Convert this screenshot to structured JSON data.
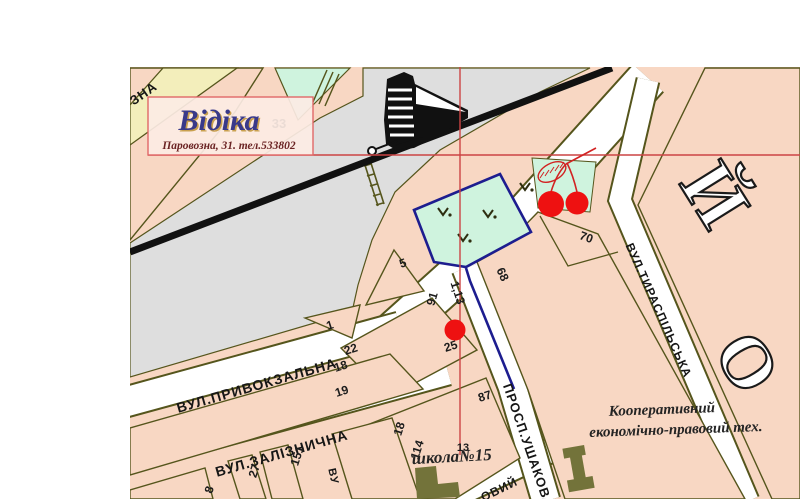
{
  "logo": {
    "brand": "Відіка",
    "address": "Паровозна, 31. тел.533802"
  },
  "streets": {
    "zna_fragment": "ЗНА",
    "pryvokzalna": "ВУЛ.ПРИВОКЗАЛЬНА",
    "zaliznychna": "ВУЛ.ЗАЛІЗНИЧНА",
    "ushakova": "ПРОСП.УШАКОВА",
    "tyraspilska": "ВУЛ.ТИРАСПІЛЬСЬКА",
    "ovyi_fragment": "ОВИЙ",
    "vu_fragment": "ВУ"
  },
  "landmarks": {
    "school": "школа№15",
    "college_line1": "Кооперативний",
    "college_line2": "економічно-правовий тех."
  },
  "district_letters": {
    "l1": "Й",
    "l2": "О"
  },
  "numbers": {
    "n33": "33",
    "n5": "5",
    "n1": "1",
    "n22": "22",
    "n25": "25",
    "n91": "91",
    "n18a": "18",
    "n19": "19",
    "n87": "87",
    "n68": "68",
    "n70": "70",
    "n13": "13",
    "n18b": "18",
    "n114": "114",
    "n151": "151",
    "n27": "27",
    "n8": "8",
    "route_distance": "1,13"
  },
  "colors": {
    "block_pink": "#f8d7c3",
    "railway_gray": "#dedede",
    "park_green": "#cff3de",
    "band_yellow": "#f3eebb",
    "street_olive": "#55551c",
    "building_olive": "#73733a",
    "route_navy": "#1d1d8f",
    "marker_red": "#ee1111",
    "crosshair_red": "#cc4444",
    "logo_border_red": "#e06868"
  }
}
